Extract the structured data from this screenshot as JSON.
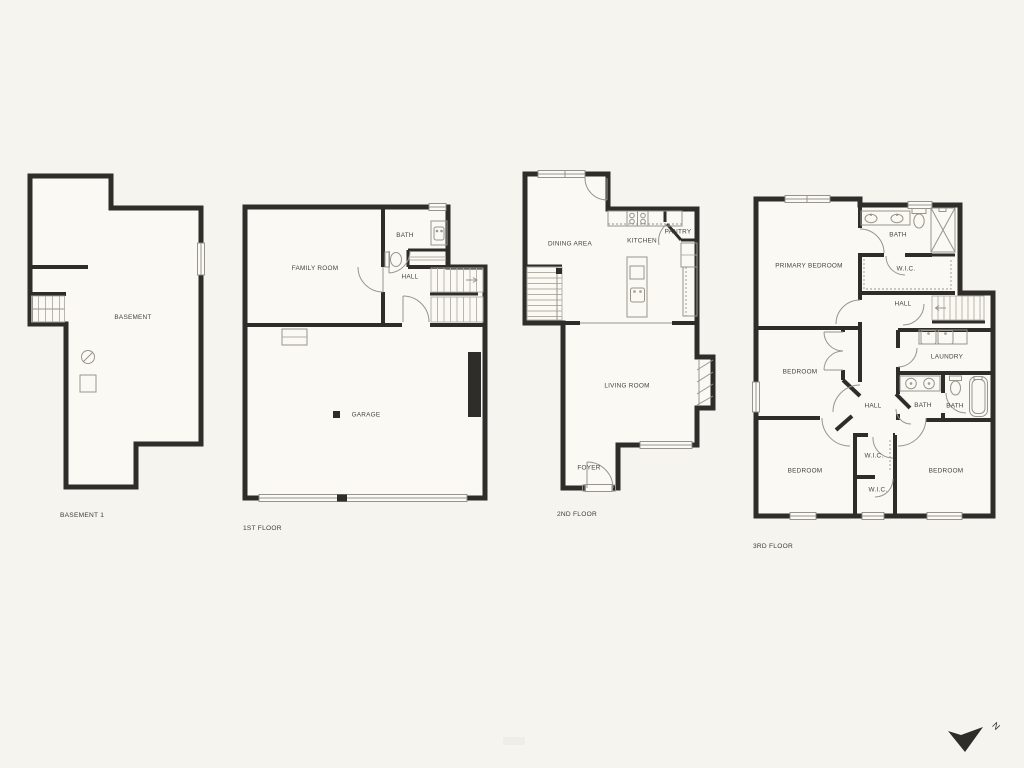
{
  "palette": {
    "background": "#f5f4ee",
    "room_fill": "#faf9f4",
    "wall": "#2e2d2a",
    "fixture_line": "#97958c",
    "label": "#454440"
  },
  "floors": [
    {
      "floor_label": "BASEMENT 1",
      "rooms": {
        "basement": "BASEMENT"
      }
    },
    {
      "floor_label": "1ST FLOOR",
      "rooms": {
        "family_room": "FAMILY ROOM",
        "bath": "BATH",
        "hall": "HALL",
        "garage": "GARAGE"
      }
    },
    {
      "floor_label": "2ND FLOOR",
      "rooms": {
        "dining_area": "DINING AREA",
        "kitchen": "KITCHEN",
        "pantry": "PANTRY",
        "living_room": "LIVING ROOM",
        "foyer": "FOYER"
      }
    },
    {
      "floor_label": "3RD FLOOR",
      "rooms": {
        "primary_bedroom": "PRIMARY BEDROOM",
        "bath_top": "BATH",
        "wic_top": "W.I.C.",
        "hall_upper": "HALL",
        "laundry": "LAUNDRY",
        "bedroom_mid": "BEDROOM",
        "hall_center": "HALL",
        "bath_hall": "BATH",
        "bath_tub": "BATH",
        "bedroom_bottom_left": "BEDROOM",
        "wic_center": "W.I.C.",
        "wic_lower": "W.I.C.",
        "bedroom_bottom_right": "BEDROOM"
      }
    }
  ],
  "compass": {
    "north_label": "N"
  }
}
